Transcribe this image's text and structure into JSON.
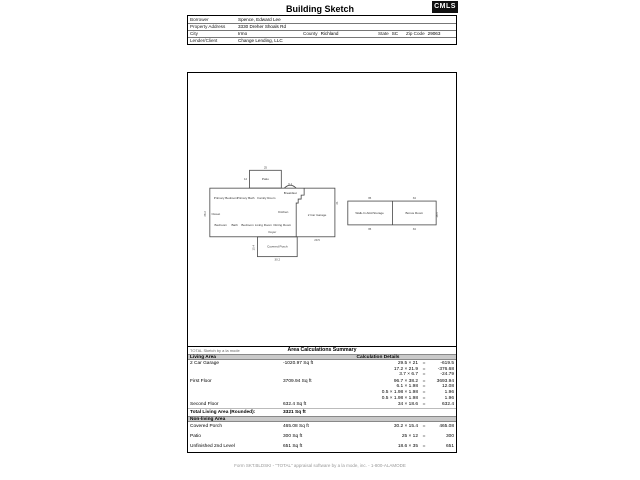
{
  "page": {
    "title": "Building Sketch",
    "logo": "CMLS",
    "footer": "Form SKT.BLDSKI - \"TOTAL\" appraisal software by a la mode, inc. - 1-800-ALAMODE"
  },
  "info": {
    "borrower_label": "Borrower",
    "borrower": "Spence, Edward Lee",
    "address_label": "Property Address",
    "address": "3330 Dreher Shoals Rd",
    "city_label": "City",
    "city": "Irmo",
    "county_label": "County",
    "county": "Richland",
    "state_label": "State",
    "state": "SC",
    "zip_label": "Zip Code",
    "zip": "29063",
    "lender_label": "Lender/Client",
    "lender": "Change Lending, LLC"
  },
  "plan": {
    "rooms": [
      "Primary Bedroom",
      "Primary Bath",
      "Family Room",
      "Closet",
      "Kitchen",
      "Breakfast",
      "Bedroom",
      "Bath",
      "Bedroom",
      "Living Room",
      "Dining Room",
      "Foyer",
      "2 Car Garage",
      "Patio",
      "Covered Porch",
      "Walk-In Attic/Storage",
      "Bonus Room"
    ],
    "dims": [
      "25",
      "12",
      "38.2",
      "6.1",
      "21",
      "29.5",
      "30.2",
      "15.4",
      "35",
      "34",
      "18.6",
      "35",
      "34"
    ]
  },
  "table": {
    "watermark": "TOTAL Sketch by a la mode",
    "title": "Area Calculations Summary",
    "living_header": "Living Area",
    "calc_header": "Calculation Details",
    "eq": "=",
    "rows": [
      {
        "name": "2 Car Garage",
        "area": "-1020.97 Sq ft",
        "calcs": [
          {
            "expr": "29.5 × 21",
            "result": "-619.5"
          },
          {
            "expr": "17.2 × 21.9",
            "result": "-376.68"
          },
          {
            "expr": "3.7 × 6.7",
            "result": "-24.79"
          }
        ]
      },
      {
        "name": "First Floor",
        "area": "3709.94 Sq ft",
        "calcs": [
          {
            "expr": "96.7 × 38.2",
            "result": "3693.94"
          },
          {
            "expr": "6.1 × 1.98",
            "result": "12.08"
          },
          {
            "expr": "0.5 × 1.98 × 1.98",
            "result": "1.96"
          },
          {
            "expr": "0.5 × 1.98 × 1.98",
            "result": "1.96"
          }
        ]
      },
      {
        "name": "Second Floor",
        "area": "632.4 Sq ft",
        "calcs": [
          {
            "expr": "34 × 18.6",
            "result": "632.4"
          }
        ]
      }
    ],
    "total_label": "Total Living Area (Rounded):",
    "total_value": "3321 Sq ft",
    "nonliving_header": "Non-living Area",
    "nonliving_rows": [
      {
        "name": "Covered Porch",
        "area": "465.08 Sq ft",
        "calcs": [
          {
            "expr": "30.2 × 15.4",
            "result": "465.08"
          }
        ]
      },
      {
        "name": "Patio",
        "area": "300 Sq ft",
        "calcs": [
          {
            "expr": "25 × 12",
            "result": "300"
          }
        ]
      },
      {
        "name": "Unfinished 2nd Level",
        "area": "651 Sq ft",
        "calcs": [
          {
            "expr": "18.6 × 35",
            "result": "651"
          }
        ]
      }
    ]
  }
}
